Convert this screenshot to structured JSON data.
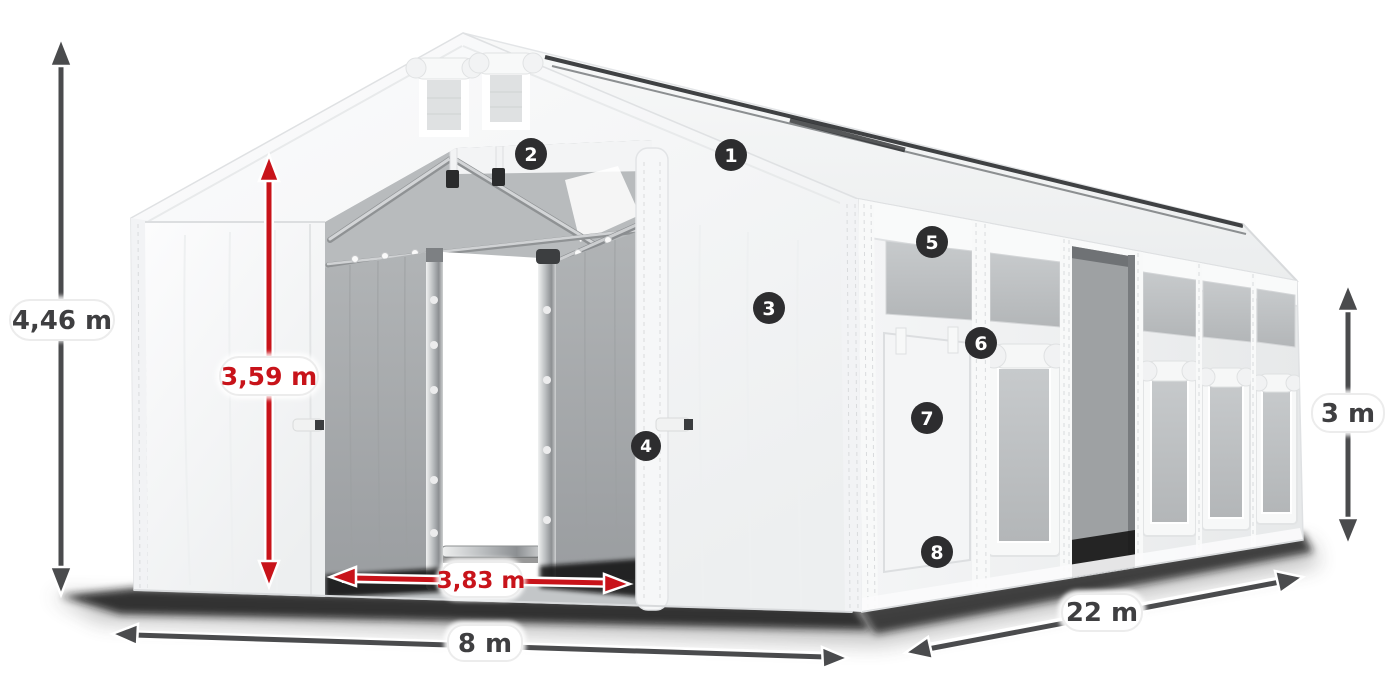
{
  "dimensions": {
    "total_height": {
      "label": "4,46 m",
      "color": "#3f3f41"
    },
    "door_height": {
      "label": "3,59 m",
      "color": "#c8131a"
    },
    "door_width": {
      "label": "3,83 m",
      "color": "#c8131a"
    },
    "gable_width": {
      "label": "8 m",
      "color": "#3f3f41"
    },
    "length": {
      "label": "22 m",
      "color": "#3f3f41"
    },
    "side_height": {
      "label": "3 m",
      "color": "#3f3f41"
    }
  },
  "markers": [
    {
      "label": "1"
    },
    {
      "label": "2"
    },
    {
      "label": "3"
    },
    {
      "label": "4"
    },
    {
      "label": "5"
    },
    {
      "label": "6"
    },
    {
      "label": "7"
    },
    {
      "label": "8"
    }
  ],
  "colors": {
    "background": "#ffffff",
    "dimension_gray": "#4a4b4d",
    "dimension_red": "#c8131a",
    "marker_bg": "#2d2d2f",
    "marker_text": "#ffffff",
    "label_pill_bg": "#ffffff"
  }
}
